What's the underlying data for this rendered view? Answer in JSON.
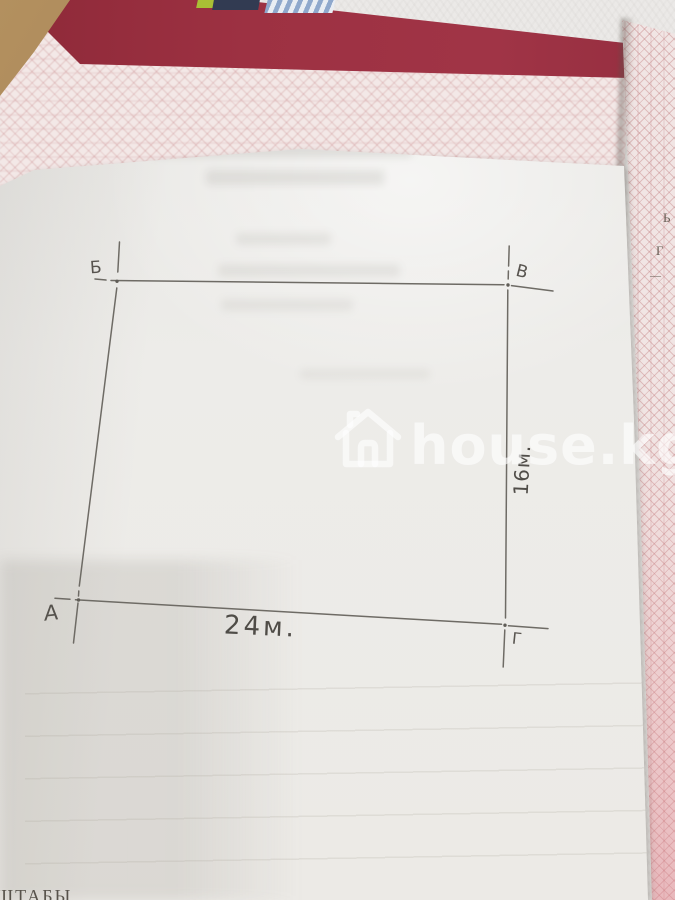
{
  "watermark": {
    "text": "house.kg",
    "icon": "house-icon"
  },
  "diagram": {
    "corner_top_left": "Б",
    "corner_top_right": "В",
    "corner_bottom_left": "А",
    "corner_bottom_right": "Г",
    "bottom_dimension": "24м.",
    "right_dimension": "16м."
  },
  "documents": {
    "bottom_left_partial_text": "ШТАБЫ",
    "right_sheet_partial_letters": [
      "Ь",
      "Г",
      "—"
    ]
  },
  "colors": {
    "folder_red": "#9c3142",
    "guilloche_pink": "#d9a7a6",
    "sheet_white": "#ecebe8",
    "pencil_gray": "#5f5c56",
    "watermark_white": "#ffffff"
  }
}
